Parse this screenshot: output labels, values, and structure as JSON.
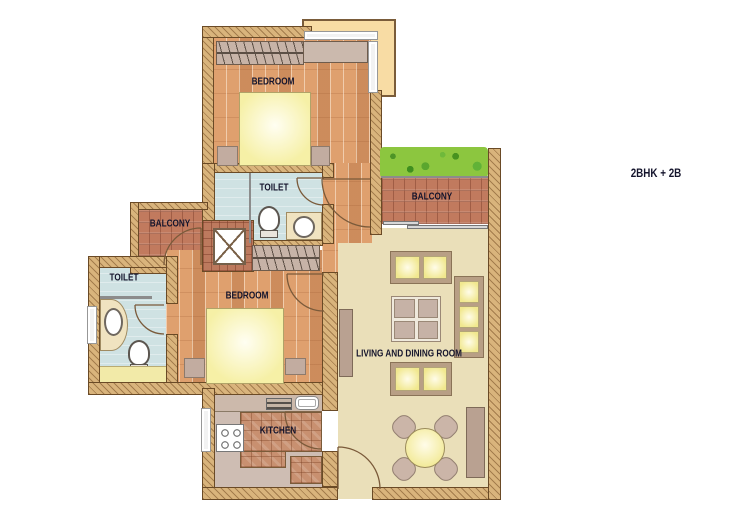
{
  "annotation": {
    "text": "2BHK + 2B"
  },
  "rooms": {
    "bedroom_top": {
      "label": "BEDROOM"
    },
    "bedroom_left": {
      "label": "BEDROOM"
    },
    "toilet_mid": {
      "label": "TOILET"
    },
    "toilet_left": {
      "label": "TOILET"
    },
    "balcony_left": {
      "label": "BALCONY"
    },
    "balcony_top": {
      "label": "BALCONY"
    },
    "kitchen": {
      "label": "KITCHEN"
    },
    "living": {
      "label": "LIVING AND DINING ROOM"
    }
  },
  "palette": {
    "wood_floor": "#dfa06e",
    "brick_floor": "#c17a5e",
    "toilet_floor": "#cfe2e3",
    "living_floor": "#eadfb9",
    "kitchen_floor": "#cebdb3",
    "wall": "#d9b47c",
    "bed_yellow": "#f6f0a6",
    "hedge_green": "#8cc63f",
    "projection_peach": "#f8dca4",
    "label_text": "#14142c"
  }
}
